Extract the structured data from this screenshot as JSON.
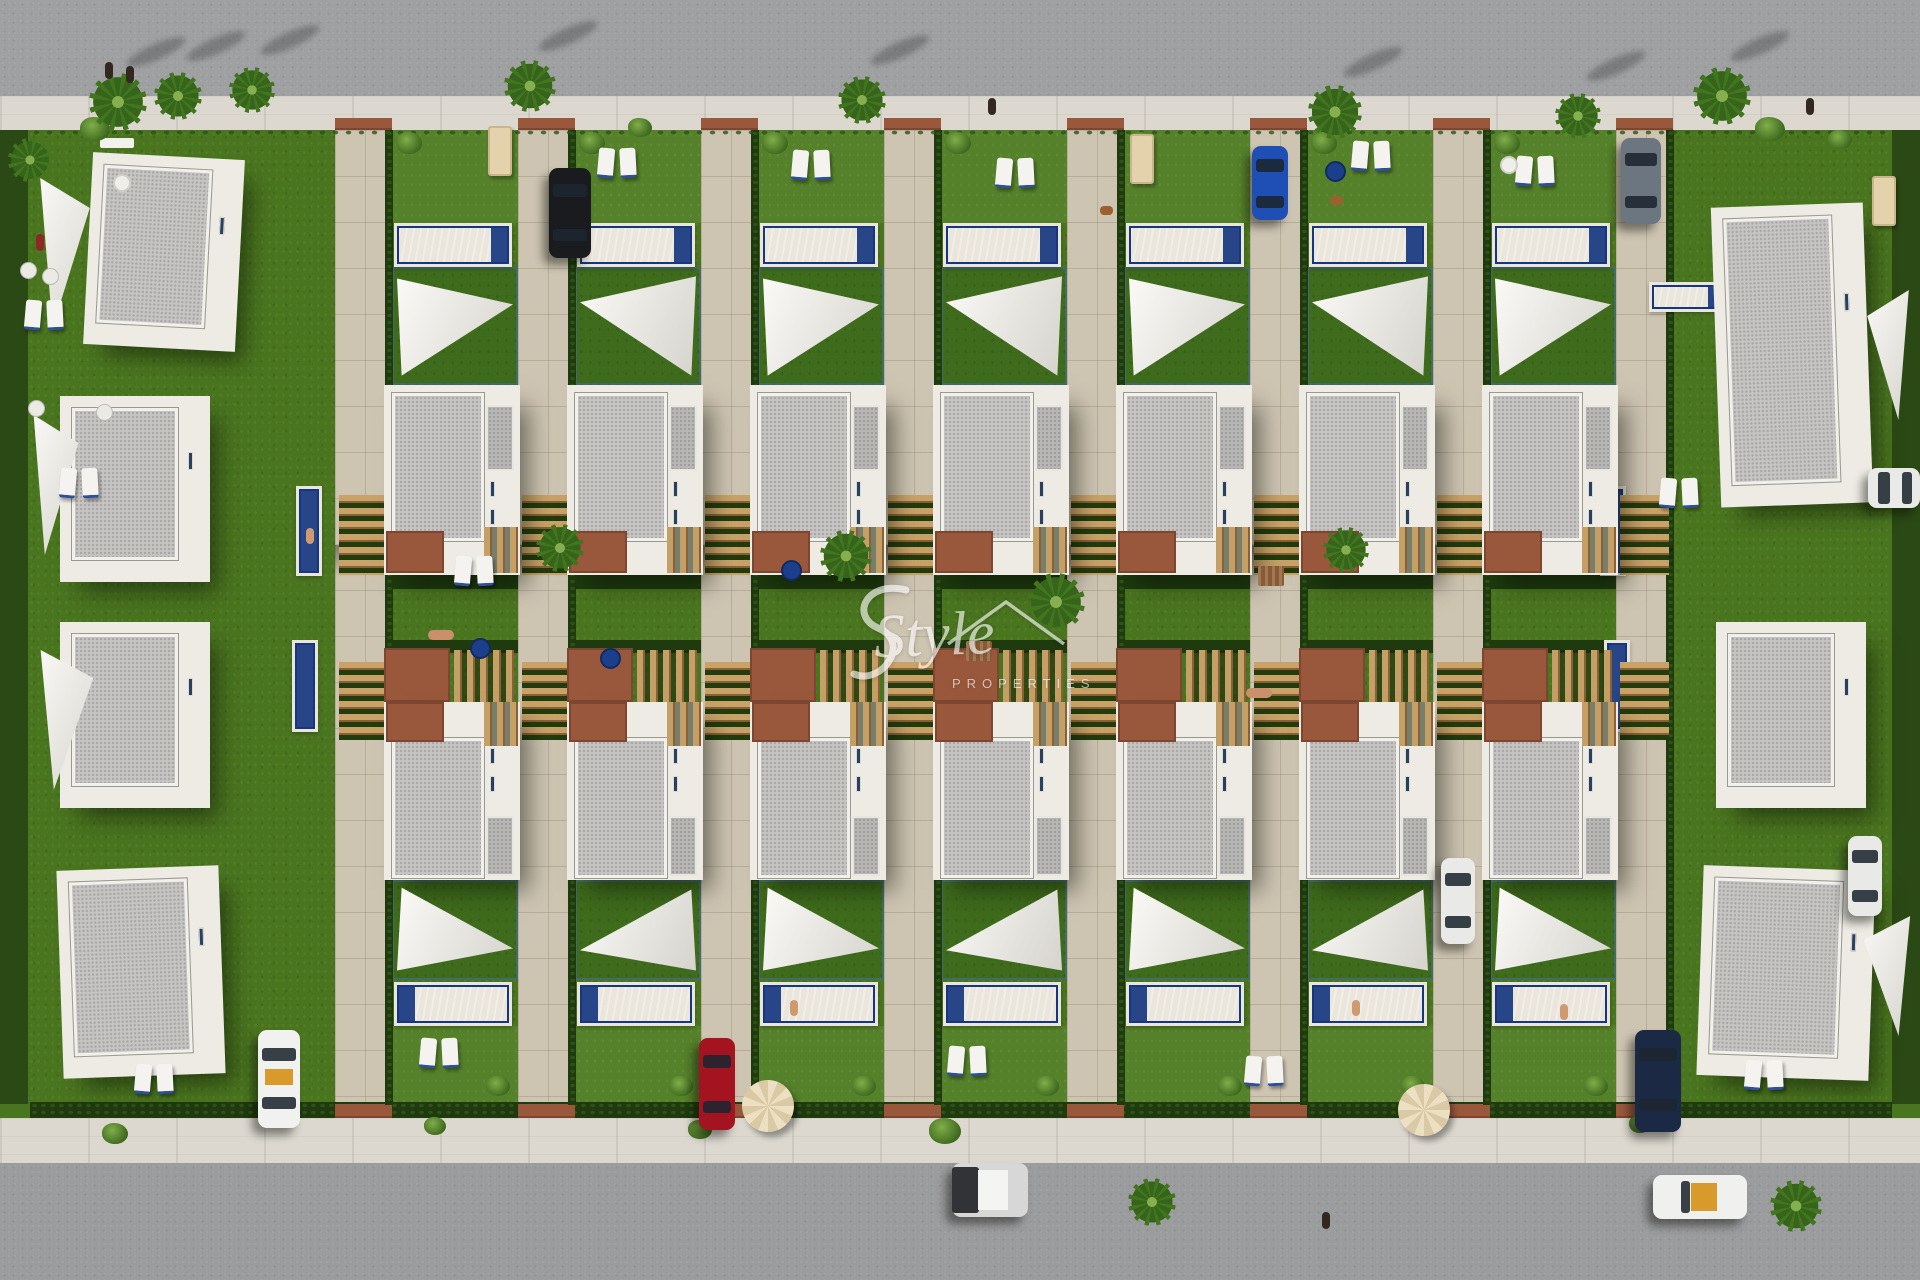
{
  "watermark": {
    "script": "Style",
    "sub": "PROPERTIES"
  },
  "palette": {
    "road": "#9fa0a2",
    "sidewalk": "#dcd8d0",
    "grass": "#4a751f",
    "front_lawn": "#55812a",
    "turf_dark": "#3f6b1c",
    "hedge": "#1e3a0e",
    "paving": "#cec4b2",
    "pool_water": "#35bfe5",
    "pool_deep": "#16377f",
    "villa_wall": "#edebe4",
    "roof_gravel": "#c6c5c3",
    "terracotta": "#99583b",
    "wood": "#c49f66",
    "sail": "#f5f3ee"
  },
  "scene": {
    "lots": {
      "lawn_xs": [
        392,
        575,
        758,
        941,
        1124,
        1307,
        1490
      ],
      "driveway_extra": 1616
    },
    "corner_villas": [
      {
        "x": 88,
        "y": 156,
        "w": 152,
        "h": 192,
        "rot": 3
      },
      {
        "x": 60,
        "y": 396,
        "w": 150,
        "h": 186,
        "rot": 0
      },
      {
        "x": 60,
        "y": 622,
        "w": 150,
        "h": 186,
        "rot": 0
      },
      {
        "x": 60,
        "y": 868,
        "w": 162,
        "h": 208,
        "rot": -2
      },
      {
        "x": 1716,
        "y": 205,
        "w": 152,
        "h": 300,
        "rot": -2
      },
      {
        "x": 1716,
        "y": 622,
        "w": 150,
        "h": 186,
        "rot": 0
      },
      {
        "x": 1700,
        "y": 868,
        "w": 172,
        "h": 210,
        "rot": 2
      }
    ],
    "corner_sails": [
      {
        "x": 34,
        "y": 178,
        "w": 62,
        "h": 150,
        "variant": "left"
      },
      {
        "x": 28,
        "y": 415,
        "w": 56,
        "h": 140,
        "variant": "left"
      },
      {
        "x": 34,
        "y": 650,
        "w": 66,
        "h": 140,
        "variant": "left"
      },
      {
        "x": 1862,
        "y": 290,
        "w": 52,
        "h": 130,
        "variant": "right"
      },
      {
        "x": 1858,
        "y": 916,
        "w": 58,
        "h": 120,
        "variant": "right"
      }
    ],
    "small_pools": [
      {
        "x": 296,
        "y": 486,
        "w": 26,
        "h": 90
      },
      {
        "x": 292,
        "y": 640,
        "w": 26,
        "h": 92
      },
      {
        "x": 1600,
        "y": 486,
        "w": 26,
        "h": 90
      },
      {
        "x": 1604,
        "y": 640,
        "w": 26,
        "h": 92
      },
      {
        "x": 1649,
        "y": 282,
        "w": 80,
        "h": 30
      }
    ],
    "cars": [
      {
        "x": 549,
        "y": 168,
        "w": 42,
        "h": 90,
        "color": "#1a1b1e",
        "name": "car-black"
      },
      {
        "x": 1252,
        "y": 146,
        "w": 36,
        "h": 74,
        "color": "#1d4fb5",
        "name": "car-blue"
      },
      {
        "x": 1621,
        "y": 138,
        "w": 40,
        "h": 86,
        "color": "#6b7681",
        "name": "car-gray"
      },
      {
        "x": 1441,
        "y": 858,
        "w": 34,
        "h": 86,
        "color": "#e9e9e7",
        "name": "car-white"
      },
      {
        "x": 1848,
        "y": 836,
        "w": 34,
        "h": 80,
        "color": "#e9e9e7",
        "name": "car-white"
      },
      {
        "x": 258,
        "y": 1030,
        "w": 42,
        "h": 98,
        "color": "#f1f1ef",
        "name": "car-white-taxi",
        "detail": "amber"
      },
      {
        "x": 699,
        "y": 1038,
        "w": 36,
        "h": 92,
        "color": "#a31420",
        "name": "car-red"
      },
      {
        "x": 1635,
        "y": 1030,
        "w": 46,
        "h": 102,
        "color": "#1b2944",
        "name": "car-navy"
      },
      {
        "x": 1868,
        "y": 468,
        "w": 52,
        "h": 40,
        "color": "#e9e9e7",
        "name": "car-white",
        "horiz": true
      },
      {
        "x": 952,
        "y": 1163,
        "w": 76,
        "h": 54,
        "color": "#d6d7d6",
        "name": "car-suv",
        "horiz": true,
        "detail": "suv"
      },
      {
        "x": 1653,
        "y": 1175,
        "w": 94,
        "h": 44,
        "color": "#f0f0ee",
        "name": "car-convertible",
        "horiz": true,
        "detail": "cabrio"
      }
    ],
    "palms": [
      {
        "x": 118,
        "y": 102,
        "d": 58
      },
      {
        "x": 178,
        "y": 96,
        "d": 48
      },
      {
        "x": 252,
        "y": 90,
        "d": 46
      },
      {
        "x": 530,
        "y": 86,
        "d": 52
      },
      {
        "x": 862,
        "y": 100,
        "d": 48
      },
      {
        "x": 1335,
        "y": 112,
        "d": 54
      },
      {
        "x": 1578,
        "y": 116,
        "d": 46
      },
      {
        "x": 1722,
        "y": 96,
        "d": 58
      },
      {
        "x": 30,
        "y": 160,
        "d": 44
      },
      {
        "x": 560,
        "y": 548,
        "d": 48
      },
      {
        "x": 846,
        "y": 556,
        "d": 52
      },
      {
        "x": 1056,
        "y": 602,
        "d": 58
      },
      {
        "x": 1346,
        "y": 550,
        "d": 46
      },
      {
        "x": 1152,
        "y": 1202,
        "d": 48
      },
      {
        "x": 1796,
        "y": 1206,
        "d": 52
      }
    ],
    "bushes": [
      {
        "x": 95,
        "y": 132,
        "d": 30
      },
      {
        "x": 640,
        "y": 130,
        "d": 24
      },
      {
        "x": 1770,
        "y": 132,
        "d": 30
      },
      {
        "x": 1840,
        "y": 142,
        "d": 24
      },
      {
        "x": 945,
        "y": 1134,
        "d": 32
      },
      {
        "x": 115,
        "y": 1136,
        "d": 26
      },
      {
        "x": 435,
        "y": 1128,
        "d": 22
      },
      {
        "x": 1640,
        "y": 1126,
        "d": 22
      },
      {
        "x": 700,
        "y": 1132,
        "d": 24
      }
    ],
    "people": [
      {
        "x": 105,
        "y": 62
      },
      {
        "x": 126,
        "y": 66
      },
      {
        "x": 988,
        "y": 98
      },
      {
        "x": 1806,
        "y": 98
      },
      {
        "x": 1322,
        "y": 1212
      },
      {
        "x": 36,
        "y": 234,
        "color": "#8e2727"
      }
    ],
    "sunbathers": [
      {
        "x": 428,
        "y": 630
      },
      {
        "x": 1246,
        "y": 688
      }
    ],
    "swimmers": [
      {
        "x": 306,
        "y": 528
      },
      {
        "x": 790,
        "y": 1000
      },
      {
        "x": 1352,
        "y": 1000
      },
      {
        "x": 1560,
        "y": 1004
      }
    ],
    "dogs": [
      {
        "x": 1330,
        "y": 196
      },
      {
        "x": 1100,
        "y": 206
      }
    ],
    "loungers": [
      {
        "x": 598,
        "y": 148
      },
      {
        "x": 792,
        "y": 150
      },
      {
        "x": 996,
        "y": 158
      },
      {
        "x": 1352,
        "y": 141
      },
      {
        "x": 1516,
        "y": 156
      },
      {
        "x": 420,
        "y": 1038
      },
      {
        "x": 948,
        "y": 1046
      },
      {
        "x": 1245,
        "y": 1056
      },
      {
        "x": 1745,
        "y": 1060
      },
      {
        "x": 135,
        "y": 1064
      },
      {
        "x": 1660,
        "y": 478
      },
      {
        "x": 25,
        "y": 300
      },
      {
        "x": 60,
        "y": 468
      },
      {
        "x": 455,
        "y": 556
      }
    ],
    "tables": [
      {
        "type": "dining",
        "x": 488,
        "y": 126
      },
      {
        "type": "dining",
        "x": 1130,
        "y": 134
      },
      {
        "type": "dining",
        "x": 1872,
        "y": 176
      },
      {
        "type": "round-white",
        "x": 113,
        "y": 174
      },
      {
        "type": "round-white",
        "x": 1500,
        "y": 156
      },
      {
        "type": "round-navy",
        "x": 1325,
        "y": 161
      },
      {
        "type": "round-navy",
        "x": 470,
        "y": 638
      },
      {
        "type": "round-navy",
        "x": 600,
        "y": 648
      },
      {
        "type": "round-navy",
        "x": 781,
        "y": 560
      },
      {
        "type": "picnic",
        "x": 966,
        "y": 641
      },
      {
        "type": "picnic",
        "x": 1258,
        "y": 566
      }
    ],
    "parasols": [
      {
        "x": 742,
        "y": 1080
      },
      {
        "x": 1398,
        "y": 1084
      }
    ],
    "chairs": [
      {
        "x": 20,
        "y": 262
      },
      {
        "x": 42,
        "y": 268
      },
      {
        "x": 28,
        "y": 400
      },
      {
        "x": 96,
        "y": 404
      }
    ],
    "benches": [
      {
        "x": 100,
        "y": 138,
        "w": 34,
        "h": 10
      }
    ]
  }
}
